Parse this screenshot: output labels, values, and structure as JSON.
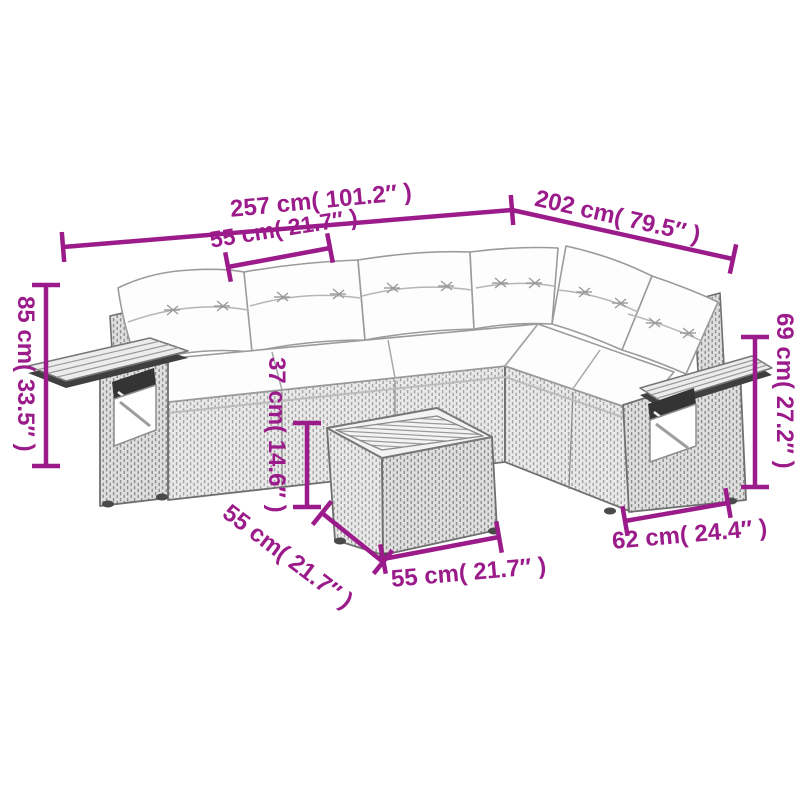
{
  "figure": {
    "description": "Line-art dimension diagram of a grey poly-rattan L-shaped garden lounge set with white cushions, fold-out arm trays and a square slatted coffee table"
  },
  "colors": {
    "dimension_annotation": "#9b1b8a",
    "background": "#ffffff",
    "line_art": "#6f6f6f",
    "wicker_fill": "#e9e9e9",
    "cushion_fill": "#fdfdfd",
    "dark_detail": "#3a3a3a"
  },
  "dimensions": {
    "overall_width": {
      "cm": "257",
      "inches": "101.2",
      "label": "257 cm( 101.2″ )"
    },
    "overall_depth": {
      "cm": "202",
      "inches": "79.5",
      "label": "202 cm( 79.5″ )"
    },
    "seat_module_width": {
      "cm": "55",
      "inches": "21.7",
      "label": "55 cm( 21.7″ )"
    },
    "overall_height": {
      "cm": "85",
      "inches": "33.5",
      "label": "85 cm( 33.5″ )"
    },
    "right_back_height": {
      "cm": "69",
      "inches": "27.2",
      "label": "69 cm( 27.2″ )"
    },
    "table_height": {
      "cm": "37",
      "inches": "14.6",
      "label": "37 cm( 14.6″ )"
    },
    "table_depth": {
      "cm": "55",
      "inches": "21.7",
      "label": "55 cm( 21.7″ )"
    },
    "table_width": {
      "cm": "55",
      "inches": "21.7",
      "label": "55 cm( 21.7″ )"
    },
    "arm_module_width": {
      "cm": "62",
      "inches": "24.4",
      "label": "62 cm( 24.4″ )"
    }
  }
}
